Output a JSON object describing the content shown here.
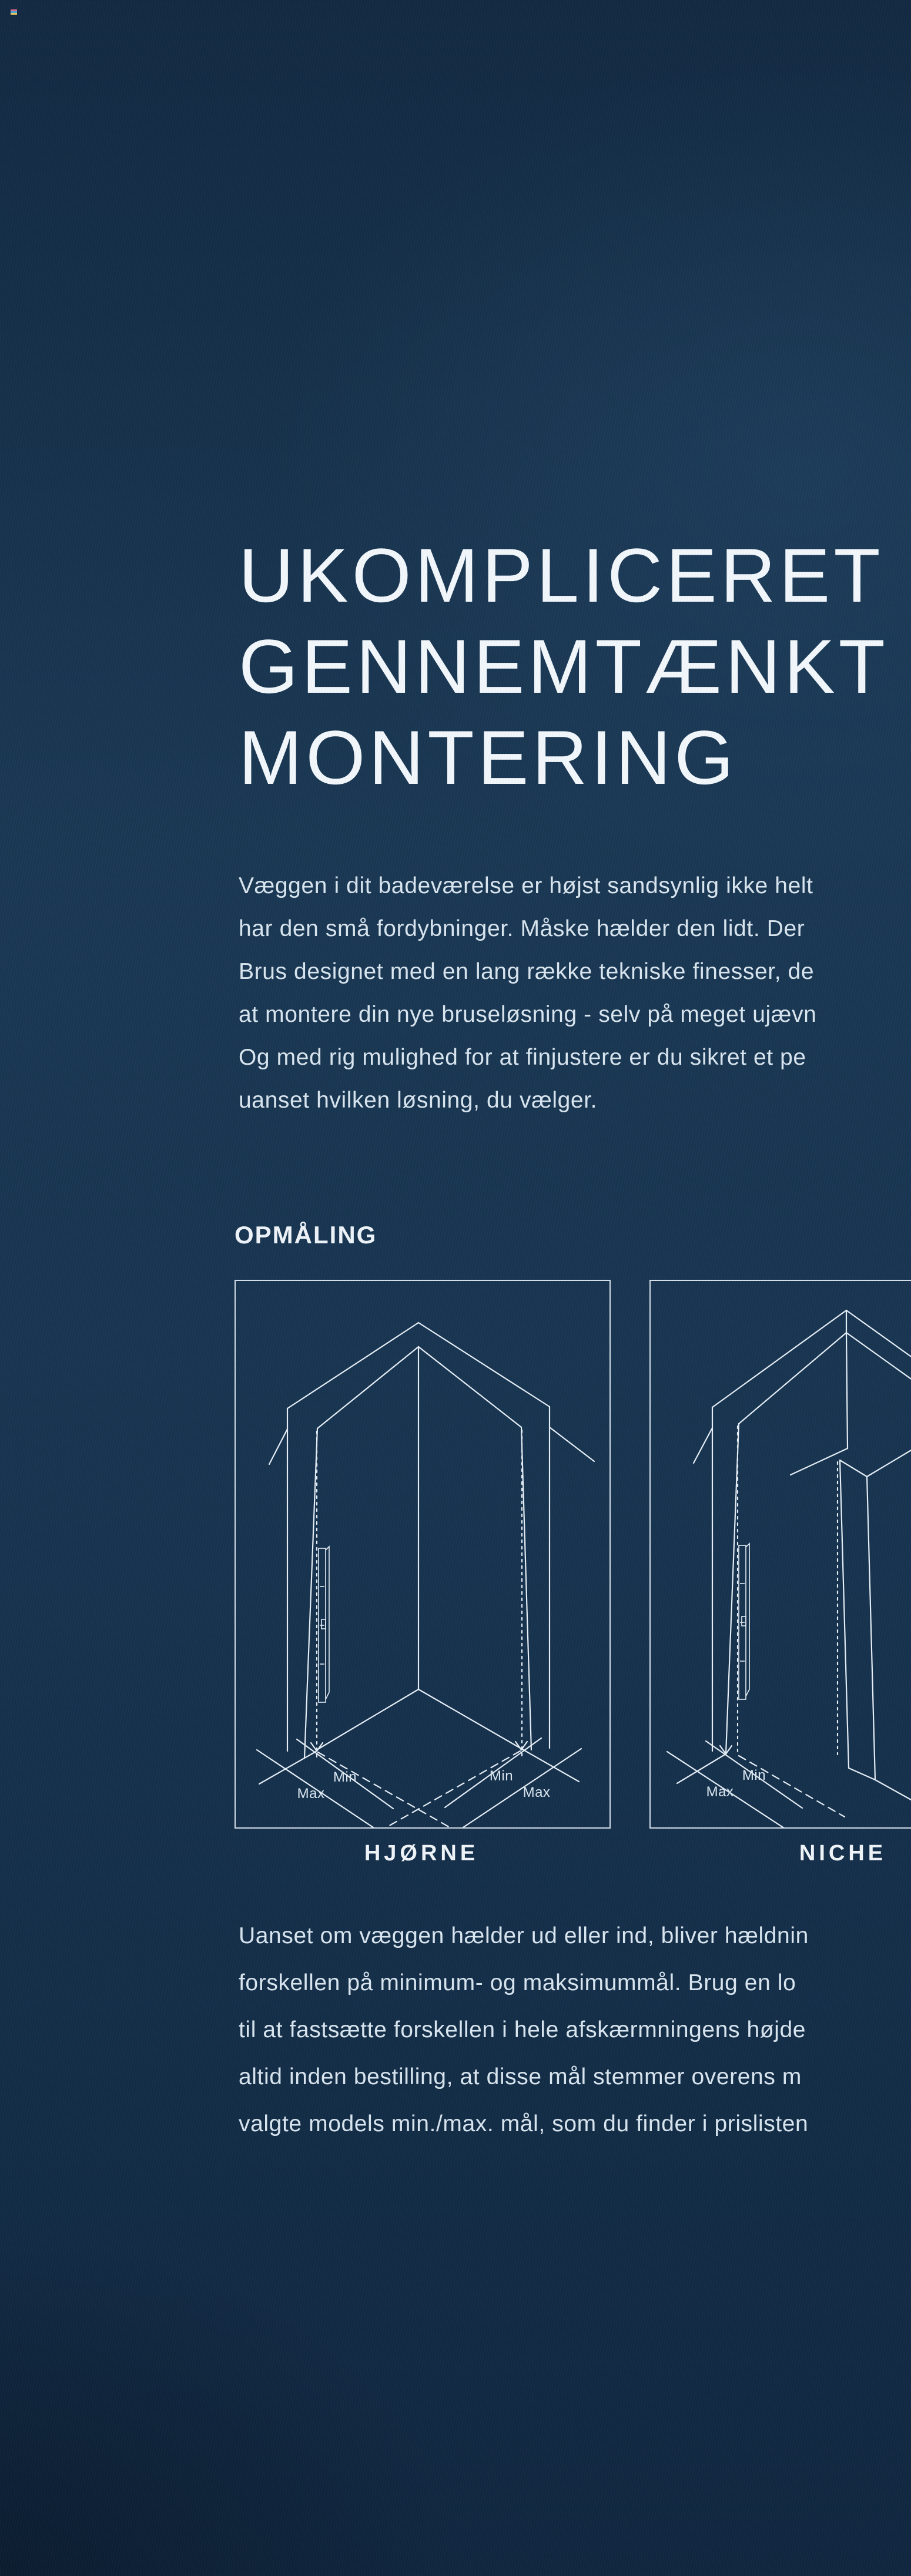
{
  "content": {
    "marker": {
      "name": "corner-color-marker",
      "colors": [
        "#d96a84",
        "#4fa3d8",
        "#e9c95e"
      ]
    },
    "title_lines": [
      "UKOMPLICERET",
      "GENNEMTÆNKT",
      "MONTERING"
    ],
    "intro_lines": [
      "Væggen i dit badeværelse er højst sandsynlig ikke helt",
      "har den små fordybninger. Måske hælder den lidt. Der",
      "Brus designet med en lang række tekniske finesser, de",
      "at montere din nye bruseløsning - selv på meget ujævn",
      "Og med rig mulighed for at finjustere er du sikret et pe",
      "uanset hvilken løsning, du vælger."
    ],
    "section_heading": "OPMÅLING",
    "figures": [
      {
        "label": "HJØRNE",
        "annotations": {
          "left_min": "Min",
          "left_max": "Max",
          "right_min": "Min",
          "right_max": "Max"
        }
      },
      {
        "label": "NICHE",
        "annotations": {
          "min": "Min",
          "max": "Max"
        }
      }
    ],
    "body_lines": [
      "Uanset om væggen hælder ud eller ind, bliver hældnin",
      "forskellen på minimum- og maksimummål. Brug en lo",
      "til at fastsætte forskellen i hele afskærmningens højde",
      "altid inden bestilling, at disse mål stemmer overens m",
      "valgte models min./max. mål, som du finder i prislisten"
    ],
    "colors": {
      "background_top": "#122a42",
      "background_mid": "#1a3854",
      "background_bottom": "#102740",
      "text": "#d9e6f0",
      "title": "#f3f8fc",
      "diagram_line": "#e7eff7",
      "frame_border": "#e6f0f8"
    }
  }
}
